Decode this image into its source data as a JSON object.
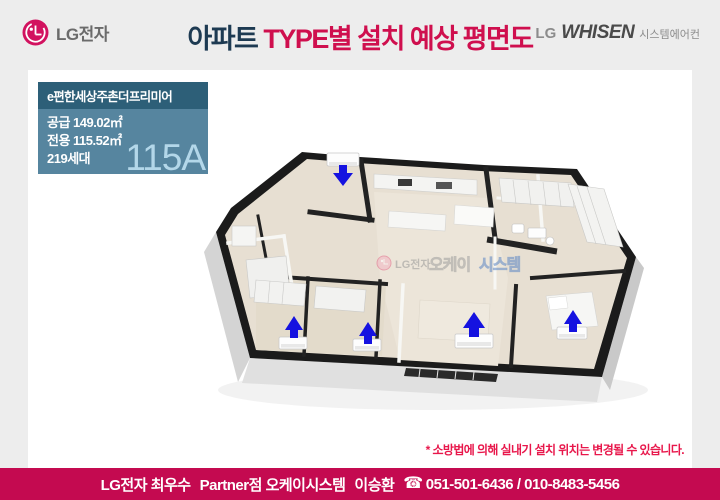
{
  "header": {
    "logo_text": "LG전자",
    "title": {
      "prefix": "아파트 ",
      "highlight": "TYPE별 설치 예상 평면도"
    },
    "brand": {
      "lg": "LG",
      "whisen": "WHISEN",
      "product": "시스템에어컨"
    }
  },
  "unit_info": {
    "complex_name": "e편한세상주촌더프리미어",
    "supply": "공급 149.02㎡",
    "exclusive": "전용 115.52㎡",
    "households": "219세대",
    "type_code": "115A"
  },
  "floorplan": {
    "watermark": {
      "lg": "LG전자",
      "okay": "오케이",
      "system": "시스템"
    },
    "ac_indoor_unit_count": 5,
    "arrow_color": "#1512e0"
  },
  "disclaimer": "* 소방법에 의해 실내기 설치 위치는 변경될 수 있습니다.",
  "footer": {
    "dealer": "LG전자 최우수",
    "partner": "Partner점 오케이시스템",
    "person": "이승환",
    "phone_icon": "☎",
    "phones": "051-501-6436 / 010-8483-5456"
  },
  "colors": {
    "accent_crimson": "#c40a50",
    "title_navy": "#1d3a52",
    "title_red": "#cf0f4e",
    "infobox_header_bg": "#2d5f78",
    "infobox_body_bg": "#56859f",
    "type_code_text": "#b3d7e9",
    "disclaimer_red": "#e8174b"
  }
}
